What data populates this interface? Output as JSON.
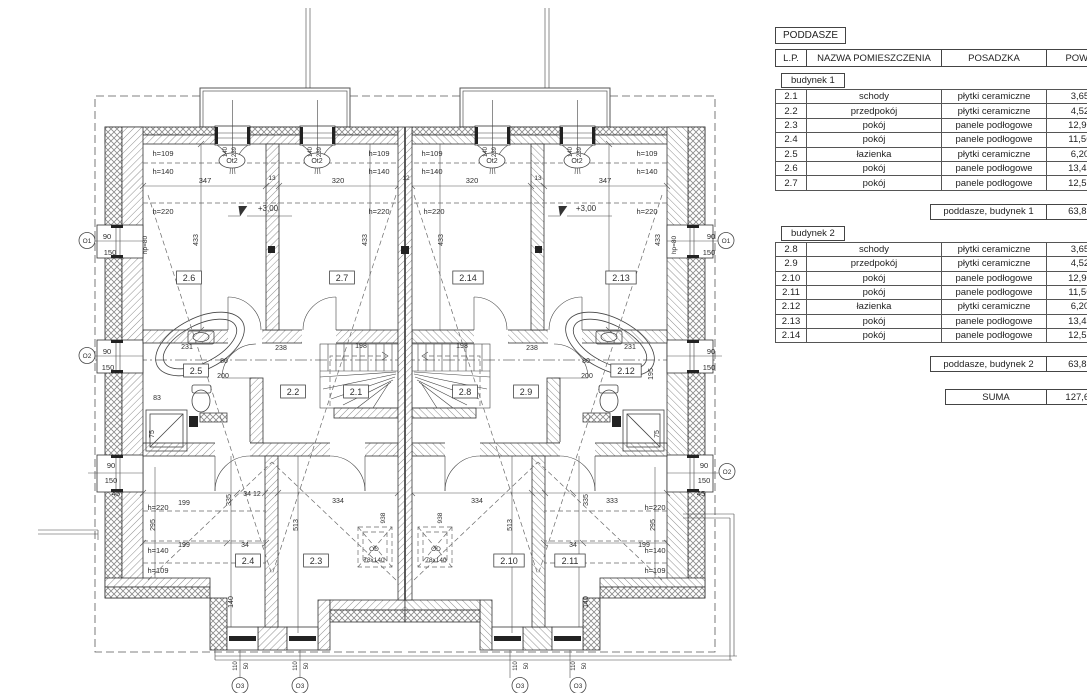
{
  "table": {
    "title": "PODDASZE",
    "columns": [
      "L.P.",
      "NAZWA POMIESZCZENIA",
      "POSADZKA",
      "POW.UŻ."
    ],
    "sections": [
      {
        "label": "budynek 1",
        "rows": [
          [
            "2.1",
            "schody",
            "płytki ceramiczne",
            "3,65m²"
          ],
          [
            "2.2",
            "przedpokój",
            "płytki ceramiczne",
            "4,52m²"
          ],
          [
            "2.3",
            "pokój",
            "panele podłogowe",
            "12,90m²"
          ],
          [
            "2.4",
            "pokój",
            "panele podłogowe",
            "11,56m²"
          ],
          [
            "2.5",
            "łazienka",
            "płytki ceramiczne",
            "6,20m²"
          ],
          [
            "2.6",
            "pokój",
            "panele podłogowe",
            "13,45m²"
          ],
          [
            "2.7",
            "pokój",
            "panele podłogowe",
            "12,53m²"
          ]
        ],
        "summary": {
          "label": "poddasze, budynek 1",
          "value": "63,81m²"
        }
      },
      {
        "label": "budynek 2",
        "rows": [
          [
            "2.8",
            "schody",
            "płytki ceramiczne",
            "3,65m²"
          ],
          [
            "2.9",
            "przedpokój",
            "płytki ceramiczne",
            "4,52m²"
          ],
          [
            "2.10",
            "pokój",
            "panele podłogowe",
            "12,90m²"
          ],
          [
            "2.11",
            "pokój",
            "panele podłogowe",
            "11,56m²"
          ],
          [
            "2.12",
            "łazienka",
            "płytki ceramiczne",
            "6,20m²"
          ],
          [
            "2.13",
            "pokój",
            "panele podłogowe",
            "13,45m²"
          ],
          [
            "2.14",
            "pokój",
            "panele podłogowe",
            "12,53m²"
          ]
        ],
        "summary": {
          "label": "poddasze, budynek 2",
          "value": "63,81m²"
        }
      }
    ],
    "total": {
      "label": "SUMA",
      "value": "127,62m²"
    }
  },
  "plan": {
    "labels": [
      {
        "t": "2.6",
        "x": 189,
        "y": 281,
        "k": "b",
        "s": 9
      },
      {
        "t": "2.7",
        "x": 342,
        "y": 281,
        "k": "b",
        "s": 9
      },
      {
        "t": "2.14",
        "x": 468,
        "y": 281,
        "k": "b",
        "s": 9
      },
      {
        "t": "2.13",
        "x": 621,
        "y": 281,
        "k": "b",
        "s": 9
      },
      {
        "t": "2.5",
        "x": 196,
        "y": 374,
        "k": "b",
        "s": 9
      },
      {
        "t": "2.2",
        "x": 293,
        "y": 395,
        "k": "b",
        "s": 9
      },
      {
        "t": "2.1",
        "x": 356,
        "y": 395,
        "k": "b",
        "s": 9
      },
      {
        "t": "2.8",
        "x": 465,
        "y": 395,
        "k": "b",
        "s": 9
      },
      {
        "t": "2.9",
        "x": 526,
        "y": 395,
        "k": "b",
        "s": 9
      },
      {
        "t": "2.12",
        "x": 626,
        "y": 374,
        "k": "b",
        "s": 9
      },
      {
        "t": "2.4",
        "x": 248,
        "y": 564,
        "k": "b",
        "s": 9
      },
      {
        "t": "2.3",
        "x": 316,
        "y": 564,
        "k": "b",
        "s": 9
      },
      {
        "t": "2.10",
        "x": 509,
        "y": 564,
        "k": "b",
        "s": 9
      },
      {
        "t": "2.11",
        "x": 570,
        "y": 564,
        "k": "b",
        "s": 9
      },
      {
        "t": "347",
        "x": 205,
        "y": 183,
        "s": 7.5
      },
      {
        "t": "320",
        "x": 338,
        "y": 183,
        "s": 7.5
      },
      {
        "t": "320",
        "x": 472,
        "y": 183,
        "s": 7.5
      },
      {
        "t": "347",
        "x": 605,
        "y": 183,
        "s": 7.5
      },
      {
        "t": "13",
        "x": 272,
        "y": 180,
        "s": 6.5
      },
      {
        "t": "12",
        "x": 406,
        "y": 180,
        "s": 6.5
      },
      {
        "t": "13",
        "x": 538,
        "y": 180,
        "s": 6.5
      },
      {
        "t": "433",
        "x": 198,
        "y": 240,
        "r": -90,
        "s": 7
      },
      {
        "t": "433",
        "x": 367,
        "y": 240,
        "r": -90,
        "s": 7
      },
      {
        "t": "433",
        "x": 443,
        "y": 240,
        "r": -90,
        "s": 7
      },
      {
        "t": "433",
        "x": 660,
        "y": 240,
        "r": -90,
        "s": 7
      },
      {
        "t": "h=109",
        "x": 163,
        "y": 156,
        "s": 7.5
      },
      {
        "t": "h=140",
        "x": 163,
        "y": 174,
        "s": 7.5
      },
      {
        "t": "h=220",
        "x": 163,
        "y": 214,
        "s": 7.5
      },
      {
        "t": "h=109",
        "x": 379,
        "y": 156,
        "s": 7.5
      },
      {
        "t": "h=140",
        "x": 379,
        "y": 174,
        "s": 7.5
      },
      {
        "t": "h=220",
        "x": 379,
        "y": 214,
        "s": 7.5
      },
      {
        "t": "h=109",
        "x": 432,
        "y": 156,
        "s": 7.5
      },
      {
        "t": "h=140",
        "x": 432,
        "y": 174,
        "s": 7.5
      },
      {
        "t": "h=220",
        "x": 434,
        "y": 214,
        "s": 7.5
      },
      {
        "t": "h=109",
        "x": 647,
        "y": 156,
        "s": 7.5
      },
      {
        "t": "h=140",
        "x": 647,
        "y": 174,
        "s": 7.5
      },
      {
        "t": "h=220",
        "x": 647,
        "y": 214,
        "s": 7.5
      },
      {
        "t": "+3,00",
        "x": 268,
        "y": 211,
        "s": 8
      },
      {
        "t": "+3,00",
        "x": 586,
        "y": 211,
        "s": 8
      },
      {
        "t": "Ot2",
        "x": 232,
        "y": 163,
        "k": "e",
        "s": 7
      },
      {
        "t": "Ot2",
        "x": 317,
        "y": 163,
        "k": "e",
        "s": 7
      },
      {
        "t": "Ot2",
        "x": 492,
        "y": 163,
        "k": "e",
        "s": 7
      },
      {
        "t": "Ot2",
        "x": 577,
        "y": 163,
        "k": "e",
        "s": 7
      },
      {
        "t": "140",
        "x": 227,
        "y": 152,
        "r": -90,
        "s": 6
      },
      {
        "t": "239",
        "x": 236,
        "y": 152,
        "r": -90,
        "s": 6
      },
      {
        "t": "140",
        "x": 312,
        "y": 152,
        "r": -90,
        "s": 6
      },
      {
        "t": "239",
        "x": 321,
        "y": 152,
        "r": -90,
        "s": 6
      },
      {
        "t": "140",
        "x": 487,
        "y": 152,
        "r": -90,
        "s": 6
      },
      {
        "t": "239",
        "x": 496,
        "y": 152,
        "r": -90,
        "s": 6
      },
      {
        "t": "140",
        "x": 572,
        "y": 152,
        "r": -90,
        "s": 6
      },
      {
        "t": "239",
        "x": 581,
        "y": 152,
        "r": -90,
        "s": 6
      },
      {
        "t": "90",
        "x": 107,
        "y": 239,
        "s": 7.5
      },
      {
        "t": "150",
        "x": 110,
        "y": 255,
        "s": 7.5
      },
      {
        "t": "hp=80",
        "x": 147,
        "y": 245,
        "r": -90,
        "s": 6.5
      },
      {
        "t": "90",
        "x": 107,
        "y": 354,
        "s": 7.5
      },
      {
        "t": "150",
        "x": 108,
        "y": 370,
        "s": 7.5
      },
      {
        "t": "90",
        "x": 111,
        "y": 468,
        "s": 7.5
      },
      {
        "t": "150",
        "x": 111,
        "y": 483,
        "s": 7.5
      },
      {
        "t": "45",
        "x": 116,
        "y": 496,
        "s": 7.5
      },
      {
        "t": "90",
        "x": 711,
        "y": 239,
        "s": 7.5
      },
      {
        "t": "150",
        "x": 709,
        "y": 255,
        "s": 7.5
      },
      {
        "t": "hp=80",
        "x": 676,
        "y": 245,
        "r": -90,
        "s": 6.5
      },
      {
        "t": "90",
        "x": 711,
        "y": 354,
        "s": 7.5
      },
      {
        "t": "150",
        "x": 709,
        "y": 370,
        "s": 7.5
      },
      {
        "t": "90",
        "x": 704,
        "y": 468,
        "s": 7.5
      },
      {
        "t": "150",
        "x": 704,
        "y": 483,
        "s": 7.5
      },
      {
        "t": "45",
        "x": 701,
        "y": 496,
        "s": 7.5
      },
      {
        "t": "O1",
        "x": 87,
        "y": 243,
        "k": "c",
        "s": 6.5
      },
      {
        "t": "O2",
        "x": 87,
        "y": 358,
        "k": "c",
        "s": 6.5
      },
      {
        "t": "O1",
        "x": 726,
        "y": 243,
        "k": "c",
        "s": 6.5
      },
      {
        "t": "O2",
        "x": 727,
        "y": 474,
        "k": "c",
        "s": 6.5
      },
      {
        "t": "238",
        "x": 281,
        "y": 350,
        "s": 7
      },
      {
        "t": "198",
        "x": 361,
        "y": 348,
        "s": 7
      },
      {
        "t": "198",
        "x": 462,
        "y": 348,
        "s": 7
      },
      {
        "t": "238",
        "x": 532,
        "y": 350,
        "s": 7
      },
      {
        "t": "231",
        "x": 187,
        "y": 349,
        "s": 7
      },
      {
        "t": "83",
        "x": 157,
        "y": 400,
        "s": 7
      },
      {
        "t": "80",
        "x": 224,
        "y": 363,
        "s": 7
      },
      {
        "t": "200",
        "x": 223,
        "y": 378,
        "s": 7
      },
      {
        "t": "75",
        "x": 154,
        "y": 434,
        "r": -90,
        "s": 7
      },
      {
        "t": "231",
        "x": 630,
        "y": 349,
        "s": 7
      },
      {
        "t": "80",
        "x": 586,
        "y": 363,
        "s": 7
      },
      {
        "t": "200",
        "x": 587,
        "y": 378,
        "s": 7
      },
      {
        "t": "195",
        "x": 653,
        "y": 374,
        "r": -90,
        "s": 7
      },
      {
        "t": "75",
        "x": 659,
        "y": 434,
        "r": -90,
        "s": 7
      },
      {
        "t": "199",
        "x": 184,
        "y": 505,
        "s": 7
      },
      {
        "t": "h=220",
        "x": 158,
        "y": 510,
        "s": 7.5
      },
      {
        "t": "295",
        "x": 155,
        "y": 525,
        "r": -90,
        "s": 7
      },
      {
        "t": "199",
        "x": 184,
        "y": 547,
        "s": 7
      },
      {
        "t": "h=140",
        "x": 158,
        "y": 553,
        "s": 7.5
      },
      {
        "t": "h=109",
        "x": 158,
        "y": 573,
        "s": 7.5
      },
      {
        "t": "335",
        "x": 231,
        "y": 500,
        "r": -90,
        "s": 7
      },
      {
        "t": "34 12",
        "x": 252,
        "y": 496,
        "s": 7
      },
      {
        "t": "334",
        "x": 338,
        "y": 503,
        "s": 7
      },
      {
        "t": "513",
        "x": 298,
        "y": 525,
        "r": -90,
        "s": 7
      },
      {
        "t": "34",
        "x": 245,
        "y": 547,
        "s": 7
      },
      {
        "t": "140",
        "x": 233,
        "y": 602,
        "r": -90,
        "s": 7
      },
      {
        "t": "334",
        "x": 477,
        "y": 503,
        "s": 7
      },
      {
        "t": "333",
        "x": 612,
        "y": 503,
        "s": 7
      },
      {
        "t": "335",
        "x": 588,
        "y": 500,
        "r": -90,
        "s": 7
      },
      {
        "t": "513",
        "x": 512,
        "y": 525,
        "r": -90,
        "s": 7
      },
      {
        "t": "34",
        "x": 573,
        "y": 547,
        "s": 7
      },
      {
        "t": "199",
        "x": 644,
        "y": 547,
        "s": 7
      },
      {
        "t": "h=220",
        "x": 655,
        "y": 510,
        "s": 7.5
      },
      {
        "t": "295",
        "x": 655,
        "y": 525,
        "r": -90,
        "s": 7
      },
      {
        "t": "h=140",
        "x": 655,
        "y": 553,
        "s": 7.5
      },
      {
        "t": "h=109",
        "x": 655,
        "y": 573,
        "s": 7.5
      },
      {
        "t": "140",
        "x": 588,
        "y": 602,
        "r": -90,
        "s": 7
      },
      {
        "t": "OD",
        "x": 374,
        "y": 551,
        "s": 6.5
      },
      {
        "t": "78x140",
        "x": 374,
        "y": 562,
        "s": 6.5
      },
      {
        "t": "OD",
        "x": 436,
        "y": 551,
        "s": 6.5
      },
      {
        "t": "78x140",
        "x": 436,
        "y": 562,
        "s": 6.5
      },
      {
        "t": "938",
        "x": 385,
        "y": 518,
        "r": -90,
        "s": 6.5
      },
      {
        "t": "938",
        "x": 442,
        "y": 518,
        "r": -90,
        "s": 6.5
      },
      {
        "t": "110",
        "x": 237,
        "y": 666,
        "r": -90,
        "s": 6
      },
      {
        "t": "50",
        "x": 248,
        "y": 666,
        "r": -90,
        "s": 6
      },
      {
        "t": "110",
        "x": 297,
        "y": 666,
        "r": -90,
        "s": 6
      },
      {
        "t": "50",
        "x": 308,
        "y": 666,
        "r": -90,
        "s": 6
      },
      {
        "t": "110",
        "x": 517,
        "y": 666,
        "r": -90,
        "s": 6
      },
      {
        "t": "50",
        "x": 528,
        "y": 666,
        "r": -90,
        "s": 6
      },
      {
        "t": "110",
        "x": 575,
        "y": 666,
        "r": -90,
        "s": 6
      },
      {
        "t": "50",
        "x": 586,
        "y": 666,
        "r": -90,
        "s": 6
      },
      {
        "t": "O3",
        "x": 240,
        "y": 688,
        "k": "c",
        "s": 6.5
      },
      {
        "t": "O3",
        "x": 300,
        "y": 688,
        "k": "c",
        "s": 6.5
      },
      {
        "t": "O3",
        "x": 520,
        "y": 688,
        "k": "c",
        "s": 6.5
      },
      {
        "t": "O3",
        "x": 578,
        "y": 688,
        "k": "c",
        "s": 6.5
      }
    ]
  }
}
